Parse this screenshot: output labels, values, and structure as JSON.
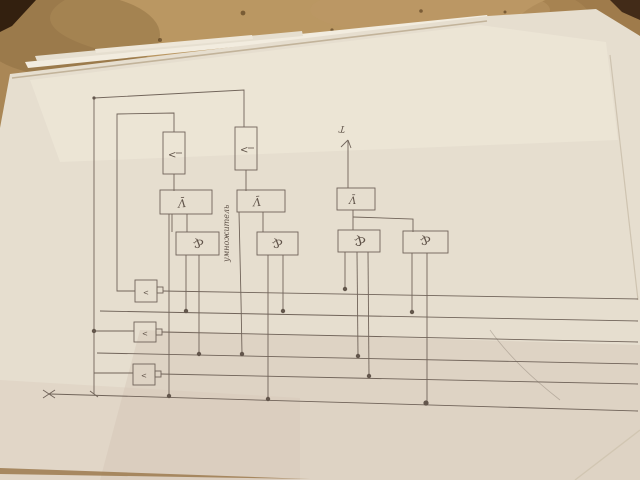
{
  "labels": {
    "and_gate": "&",
    "inverter_gate": "Ʌ̄",
    "delay_element": "<",
    "small_input_box": "<",
    "trigger_input": "T",
    "input_mark": "x",
    "vertical_annotation": "умножитель"
  },
  "colors": {
    "wood": "#aa8756",
    "paper": "#e6decf",
    "pencil_ink": "#6b5e54"
  }
}
